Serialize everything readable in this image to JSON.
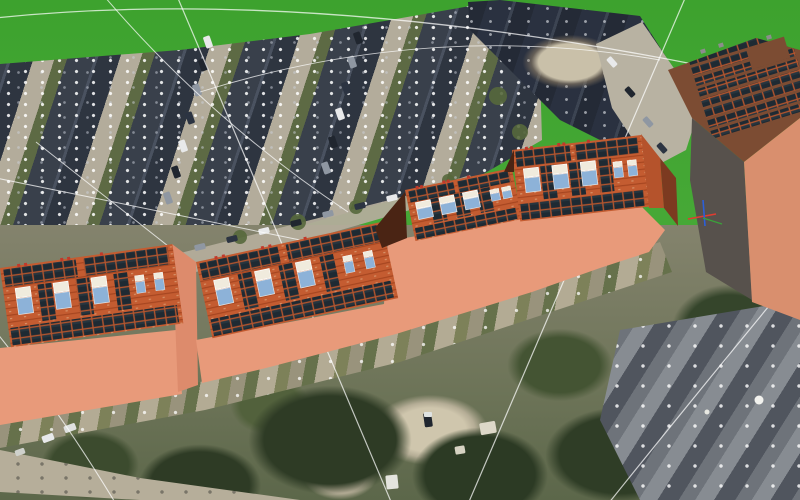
{
  "viewport": {
    "width": 800,
    "height": 500,
    "kind": "3d-model-over-aerial-imagery"
  },
  "colors": {
    "grass": "#3da22e",
    "grass2": "#47a937",
    "roof-dark": "#39404b",
    "roof-dark2": "#2e3540",
    "roof-navy": "#2a3140",
    "road": "#b3ac9b",
    "tree-dark": "#2e3b25",
    "salmon": "#e89a7a",
    "salmon2": "#dd8b6c",
    "brick": "#c45c31",
    "brick_dark": "#a4441f",
    "brick_light": "#e3b58e",
    "panel": "#1e2a33",
    "panel_hi": "#3a505a",
    "panel_gap": "#b3552e",
    "skylight_blue": "#8db2d8",
    "skylight_white": "#f0ebdd",
    "gable_shadow": "#4a2414",
    "hip_brick": "#b5532c",
    "hip_shadow": "#7c3a20",
    "tower_roof": "#7c4c33",
    "tower_wall_dark": "#57514c",
    "tower_wall_lit": "#d98f6e",
    "guide_line": "rgba(255,255,255,0.72)",
    "chimney_red": "#c0392b",
    "axis_red": "#e03c31",
    "axis_green": "#3aa13a",
    "axis_blue": "#2b5fd9",
    "car_white": "#e8e9ea",
    "car_dark": "#20262f"
  },
  "scene": {
    "terrain": {
      "label": "grass terrain plane"
    },
    "solar_building": {
      "label": "terraced rowhouse block with rooftop solar array",
      "segments": 4,
      "large_roof_windows_per_segment": 3,
      "small_roof_windows_per_segment": 2,
      "panel_rows_top": 2,
      "panel_rows_bottom": 2
    },
    "tower": {
      "label": "corner tower building with solar roof",
      "panel_rows": 8
    },
    "orbit_guides": {
      "label": "white orbit/rotation guide arcs",
      "count": 9
    },
    "axes_indicator": {
      "label": "model axes (x red, y green, z blue)"
    }
  }
}
